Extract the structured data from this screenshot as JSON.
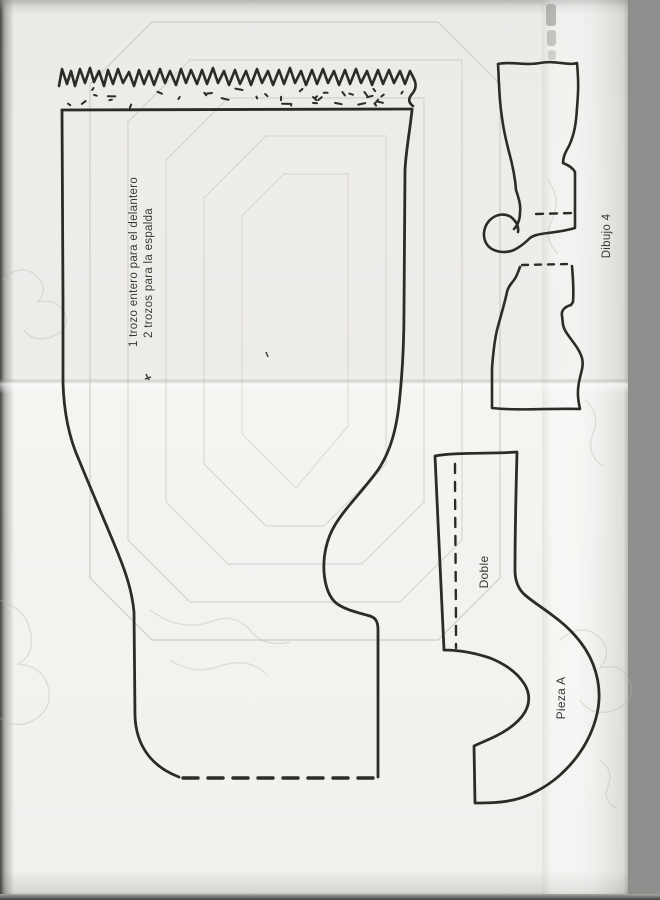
{
  "labels": {
    "main_piece": {
      "line1": "1 trozo entero para el delantero",
      "line2": "2 trozos para la espalda"
    },
    "drawing_number": "Dibujo 4",
    "fold": "Doble",
    "piece": "Pieza A"
  },
  "colors": {
    "ink": "#2d2b28",
    "paper": "#efeeec",
    "scan_background": "#8f8e8c",
    "faint_print": "#c9c7c3"
  }
}
